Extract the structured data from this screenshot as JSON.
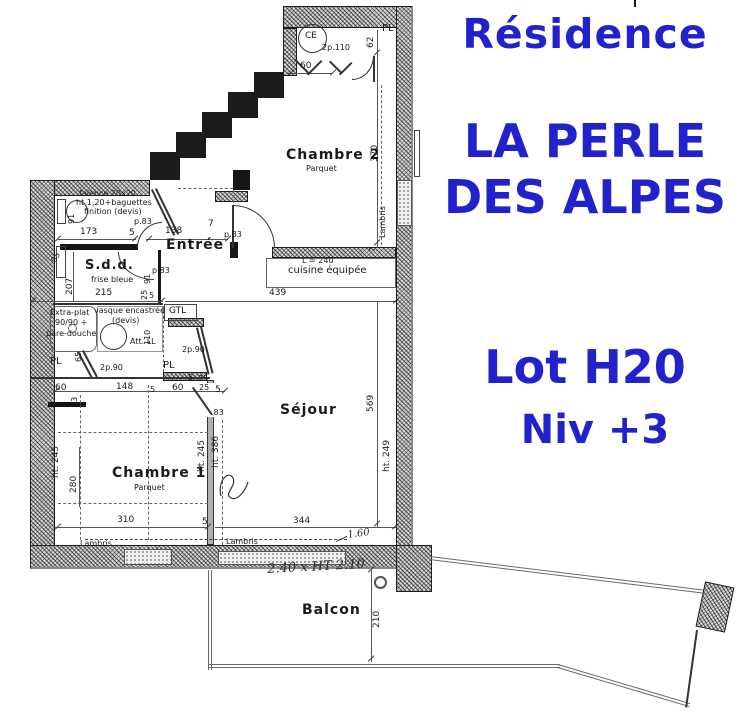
{
  "title": {
    "residence": "Résidence",
    "name_line1": "LA PERLE",
    "name_line2": "DES ALPES",
    "lot": "Lot H20",
    "level": "Niv +3",
    "color": "#2222cc"
  },
  "plan": {
    "labels": [
      {
        "t": "Chambre 2",
        "x": 286,
        "y": 148,
        "s": 14,
        "cls": "rm",
        "n": "room-label-chambre-2"
      },
      {
        "t": "Parquet",
        "x": 306,
        "y": 165,
        "s": 8,
        "n": "floor-label-chambre-2"
      },
      {
        "t": "Chambre 1",
        "x": 112,
        "y": 466,
        "s": 14,
        "cls": "rm",
        "n": "room-label-chambre-1"
      },
      {
        "t": "Parquet",
        "x": 134,
        "y": 484,
        "s": 8,
        "n": "floor-label-chambre-1"
      },
      {
        "t": "Séjour",
        "x": 280,
        "y": 403,
        "s": 14,
        "cls": "rm",
        "n": "room-label-sejour"
      },
      {
        "t": "Entrée",
        "x": 166,
        "y": 238,
        "s": 14,
        "cls": "rm",
        "n": "room-label-entree"
      },
      {
        "t": "S.d.d.",
        "x": 85,
        "y": 259,
        "s": 13,
        "cls": "rm",
        "n": "room-label-sdd"
      },
      {
        "t": "frise bleue",
        "x": 91,
        "y": 276,
        "s": 8,
        "n": "annotation-frise-bleue"
      },
      {
        "t": "Balcon",
        "x": 302,
        "y": 603,
        "s": 14,
        "cls": "rm",
        "n": "room-label-balcon"
      },
      {
        "t": "cuisine équipée",
        "x": 288,
        "y": 266,
        "s": 10,
        "n": "annotation-cuisine-equipee"
      },
      {
        "t": "L = 240",
        "x": 302,
        "y": 257,
        "s": 8,
        "n": "dim-cuisine-240"
      },
      {
        "t": "faïence 20x20",
        "x": 79,
        "y": 190,
        "s": 8,
        "n": "annotation-faience"
      },
      {
        "t": "ht 1,20+baguettes",
        "x": 76,
        "y": 199,
        "s": 8,
        "n": "annotation-baguettes"
      },
      {
        "t": "finition (devis)",
        "x": 84,
        "y": 208,
        "s": 8,
        "n": "annotation-finition"
      },
      {
        "t": "Extra-plat",
        "x": 50,
        "y": 309,
        "s": 8,
        "n": "annotation-extra-plat"
      },
      {
        "t": "90/90 +",
        "x": 55,
        "y": 319,
        "s": 8,
        "n": "annotation-extra-plat-2"
      },
      {
        "t": "pare-douche",
        "x": 46,
        "y": 330,
        "s": 8,
        "n": "annotation-pare-douche"
      },
      {
        "t": "vasque encastrée",
        "x": 94,
        "y": 307,
        "s": 8,
        "n": "annotation-vasque"
      },
      {
        "t": "(devis)",
        "x": 112,
        "y": 317,
        "s": 8,
        "n": "annotation-vasque-devis"
      },
      {
        "t": "Att. LL",
        "x": 130,
        "y": 338,
        "s": 8,
        "n": "annotation-att-ll"
      },
      {
        "t": "GTL",
        "x": 169,
        "y": 307,
        "s": 9,
        "n": "annotation-gtl"
      },
      {
        "t": "2p.90",
        "x": 182,
        "y": 346,
        "s": 8,
        "n": "door-label-2p90-hall"
      },
      {
        "t": "2p.90",
        "x": 100,
        "y": 364,
        "s": 8,
        "n": "door-label-2p90-left"
      },
      {
        "t": "2p.110",
        "x": 322,
        "y": 44,
        "s": 8,
        "n": "door-label-2p110"
      },
      {
        "t": "PL",
        "x": 382,
        "y": 24,
        "s": 10,
        "n": "closet-label-pl-ch2"
      },
      {
        "t": "PL",
        "x": 50,
        "y": 357,
        "s": 10,
        "n": "closet-label-pl-left"
      },
      {
        "t": "PL",
        "x": 163,
        "y": 361,
        "s": 10,
        "n": "closet-label-pl-hall"
      },
      {
        "t": "CE",
        "x": 305,
        "y": 32,
        "s": 9,
        "n": "fixture-label-ce"
      },
      {
        "t": "Lambris",
        "x": 379,
        "y": 238,
        "s": 8,
        "r": -90,
        "n": "annotation-lambris-right"
      },
      {
        "t": "Lambris",
        "x": 80,
        "y": 540,
        "s": 8,
        "n": "annotation-lambris-ch1"
      },
      {
        "t": "Lambris",
        "x": 226,
        "y": 538,
        "s": 8,
        "n": "annotation-lambris-sejour"
      },
      {
        "t": "60",
        "x": 300,
        "y": 62,
        "n": "dim-60-ch2"
      },
      {
        "t": "62",
        "x": 367,
        "y": 48,
        "r": -90,
        "n": "dim-62"
      },
      {
        "t": "370",
        "x": 371,
        "y": 162,
        "r": -90,
        "n": "dim-370"
      },
      {
        "t": "7",
        "x": 369,
        "y": 252,
        "r": -90,
        "s": 8,
        "n": "dim-7-cuisine"
      },
      {
        "t": "173",
        "x": 80,
        "y": 228,
        "n": "dim-173"
      },
      {
        "t": "5",
        "x": 129,
        "y": 229,
        "n": "dim-5-sdd"
      },
      {
        "t": "p.83",
        "x": 134,
        "y": 218,
        "s": 8,
        "n": "door-label-p83-sdd"
      },
      {
        "t": "138",
        "x": 165,
        "y": 227,
        "n": "dim-138"
      },
      {
        "t": "7",
        "x": 208,
        "y": 220,
        "n": "dim-7-entree"
      },
      {
        "t": "p.83",
        "x": 224,
        "y": 231,
        "s": 8,
        "n": "door-label-p83-sejour"
      },
      {
        "t": "91",
        "x": 68,
        "y": 224,
        "r": -90,
        "s": 8,
        "n": "dim-91-wc"
      },
      {
        "t": "95",
        "x": 50,
        "y": 260,
        "r": -60,
        "s": 8,
        "n": "dim-95"
      },
      {
        "t": "207",
        "x": 66,
        "y": 295,
        "r": -90,
        "n": "dim-207"
      },
      {
        "t": "215",
        "x": 95,
        "y": 289,
        "n": "dim-215"
      },
      {
        "t": "25",
        "x": 141,
        "y": 300,
        "r": -90,
        "s": 8,
        "n": "dim-25-entree"
      },
      {
        "t": "5",
        "x": 149,
        "y": 292,
        "s": 8,
        "n": "dim-5-entree"
      },
      {
        "t": "91",
        "x": 144,
        "y": 284,
        "r": -90,
        "s": 8,
        "n": "dim-91-entree"
      },
      {
        "t": "p.83",
        "x": 152,
        "y": 267,
        "s": 8,
        "n": "door-label-p83-entree"
      },
      {
        "t": "110",
        "x": 144,
        "y": 345,
        "r": -90,
        "s": 8,
        "n": "dim-110"
      },
      {
        "t": "439",
        "x": 269,
        "y": 289,
        "n": "dim-439"
      },
      {
        "t": "569",
        "x": 367,
        "y": 412,
        "r": -90,
        "n": "dim-569"
      },
      {
        "t": "ht. 249",
        "x": 383,
        "y": 472,
        "r": -90,
        "n": "dim-ht-249"
      },
      {
        "t": "65",
        "x": 75,
        "y": 362,
        "r": -90,
        "s": 8,
        "n": "dim-65"
      },
      {
        "t": "93",
        "x": 71,
        "y": 407,
        "r": -90,
        "s": 8,
        "n": "dim-93"
      },
      {
        "t": "60",
        "x": 55,
        "y": 384,
        "n": "dim-60-ch1a"
      },
      {
        "t": "148",
        "x": 116,
        "y": 383,
        "n": "dim-148"
      },
      {
        "t": "5",
        "x": 150,
        "y": 386,
        "s": 8,
        "n": "dim-5-ch1a"
      },
      {
        "t": "60",
        "x": 172,
        "y": 384,
        "n": "dim-60-ch1b"
      },
      {
        "t": "25",
        "x": 199,
        "y": 384,
        "s": 8,
        "n": "dim-25-ch1"
      },
      {
        "t": "5",
        "x": 215,
        "y": 386,
        "n": "dim-5-ch1b"
      },
      {
        "t": "5",
        "x": 188,
        "y": 374,
        "s": 8,
        "n": "dim-5-hall"
      },
      {
        "t": "25",
        "x": 198,
        "y": 375,
        "s": 8,
        "n": "dim-25-hall"
      },
      {
        "t": ".83",
        "x": 211,
        "y": 409,
        "s": 8,
        "n": "door-label-83-ch1"
      },
      {
        "t": "280",
        "x": 70,
        "y": 493,
        "r": -90,
        "n": "dim-280"
      },
      {
        "t": "ht. 245",
        "x": 52,
        "y": 478,
        "r": -90,
        "n": "dim-ht-245-left"
      },
      {
        "t": "ht. 245",
        "x": 198,
        "y": 472,
        "r": -90,
        "n": "dim-ht-245-right"
      },
      {
        "t": "ht. 386",
        "x": 212,
        "y": 468,
        "r": -90,
        "n": "dim-ht-386"
      },
      {
        "t": "310",
        "x": 117,
        "y": 516,
        "n": "dim-310"
      },
      {
        "t": "5",
        "x": 202,
        "y": 518,
        "n": "dim-5-bottom"
      },
      {
        "t": "344",
        "x": 293,
        "y": 517,
        "n": "dim-344"
      },
      {
        "t": "210",
        "x": 373,
        "y": 628,
        "r": -90,
        "n": "dim-210-balcon"
      },
      {
        "t": "2.40 x HT 2.10",
        "x": 267,
        "y": 563,
        "s": 13,
        "r": -3,
        "cls": "hw",
        "n": "handwritten-bay-dim"
      },
      {
        "t": "1.60",
        "x": 347,
        "y": 531,
        "s": 10,
        "r": -8,
        "cls": "hw",
        "n": "handwritten-160"
      }
    ]
  }
}
